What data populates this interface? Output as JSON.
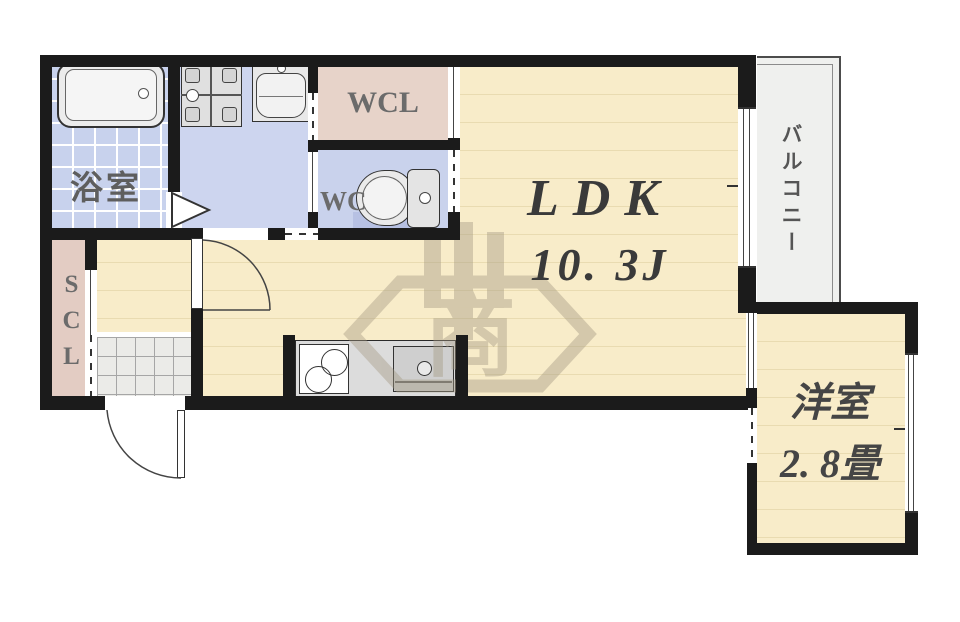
{
  "rooms": {
    "bath": {
      "label": "浴室"
    },
    "wcl": {
      "label": "WCL"
    },
    "wc": {
      "label": "WC"
    },
    "scl": {
      "label": "SCL"
    },
    "ldk": {
      "label": "LDK",
      "size": "10. 3J"
    },
    "western": {
      "label": "洋室",
      "size": "2. 8畳"
    },
    "balcony": {
      "label": "バルコニー"
    }
  },
  "watermark": {
    "text": "商"
  },
  "colors": {
    "wall": "#1b1b1b",
    "floor_wood": "#f8ecc9",
    "floor_wet": "#cdd5ef",
    "closet_pink": "#e7d3c9",
    "balcony_gray": "#eff0ee",
    "watermark": "#a49982",
    "label_gray": "#5e5e5e",
    "label_dark": "#3a3a3a"
  }
}
